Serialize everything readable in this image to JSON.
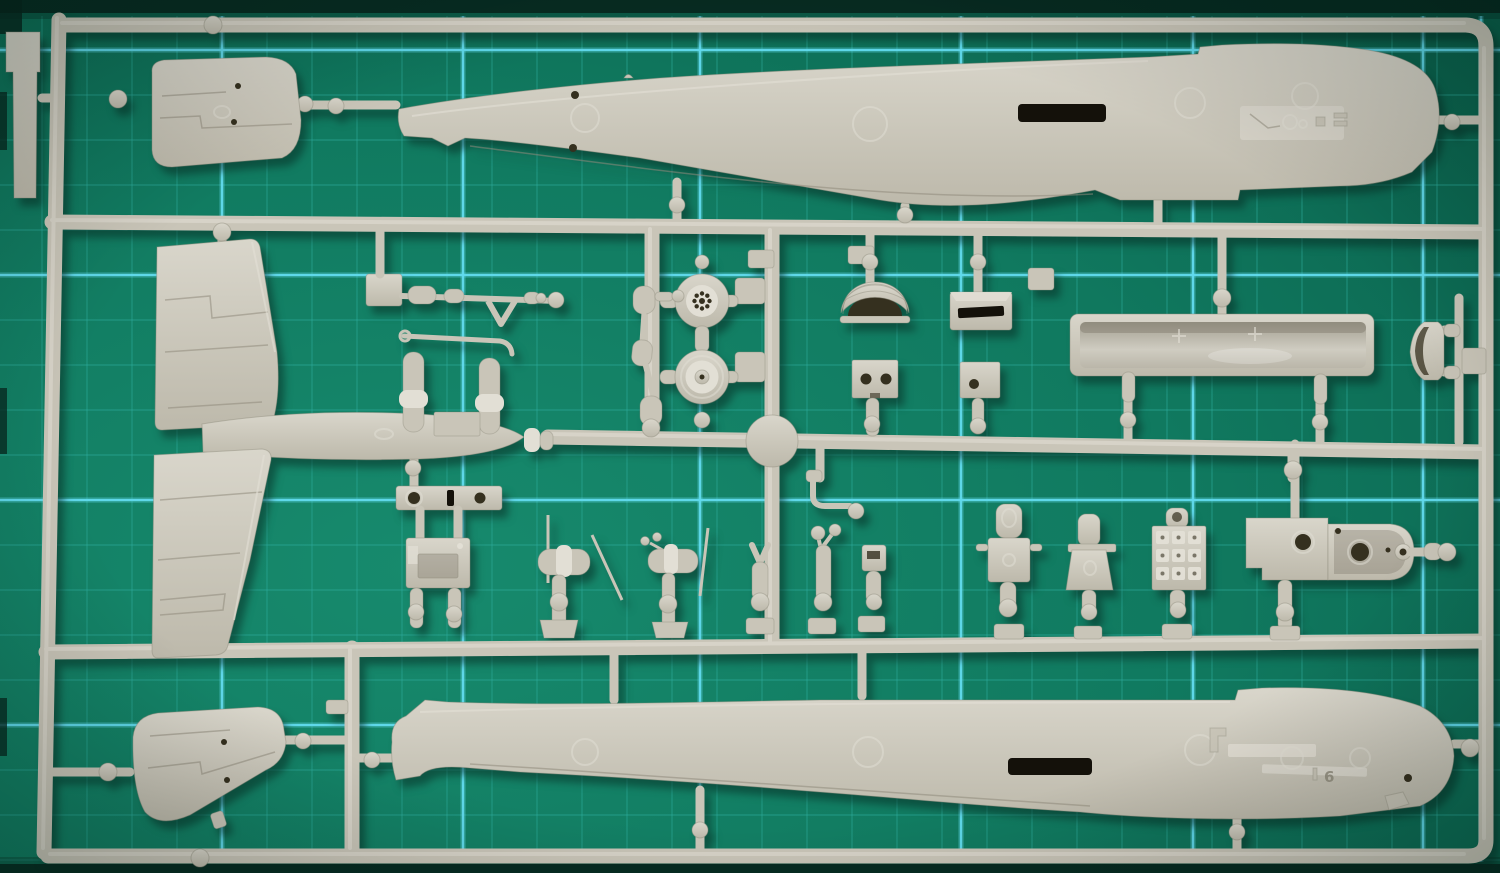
{
  "scene": {
    "type": "photograph",
    "subject": "Grey injection-moulded polystyrene model aircraft sprue (parts tree) lying flat on a green self-healing cutting mat with cyan grid lines",
    "camera": "top-down close-up",
    "visible_text": "single molded part-number digit on lower fuselage half"
  },
  "colors": {
    "mat_green_light": "#1a8d70",
    "mat_green": "#107a5f",
    "mat_green_dark": "#0a5e49",
    "mat_edge_dark": "#07261d",
    "grid_minor": "#2fae9f",
    "grid_major": "#62dbee",
    "plastic": "#c9c5b8",
    "plastic_light": "#e2dfd5",
    "plastic_dark": "#8f8b7c",
    "plastic_deep": "#6f6a5c",
    "hole_dark": "#35301f",
    "slot_black": "#14110a",
    "shadow": "rgba(5,40,31,0.5)"
  },
  "mat": {
    "description": "green self-healing cutting mat, dark top and bottom edge bands, faint 1cm teal grid with bright cyan 5cm lines",
    "grid": {
      "minor_spacing_px": 45,
      "minor_start_x": 42,
      "minor_start_y": 5,
      "minor_x_max": 1500,
      "minor_y_min": 16,
      "minor_y_max": 862,
      "major_vertical_x": [
        222,
        463,
        700,
        961,
        1193,
        1423,
        1481
      ],
      "major_horizontal_y": [
        50,
        275,
        500,
        725
      ]
    }
  },
  "sprue": {
    "material": "light grey polystyrene",
    "molded_digit": "6",
    "parts": [
      {
        "id": "sprue-frame",
        "label": "rectangular runner frame with three internal cross-runners"
      },
      {
        "id": "tab-plate",
        "label": "flat tab plate outside frame, top-left"
      },
      {
        "id": "tailplane-half-upper",
        "label": "tailplane half with elevator hinge line (top-left)"
      },
      {
        "id": "fuselage-half-upper",
        "label": "fuselage half, interior facing up, cockpit sidewall detail at nose (top)"
      },
      {
        "id": "wing-panel-upper",
        "label": "wing skin panel (left, upper)"
      },
      {
        "id": "wing-root-fairing",
        "label": "wing-root fairing section (left centre)"
      },
      {
        "id": "wing-panel-lower",
        "label": "wing skin panel (left, lower)"
      },
      {
        "id": "tailplane-half-lower",
        "label": "tailplane half (bottom-left)"
      },
      {
        "id": "fuselage-half-lower",
        "label": "fuselage half, interior facing up, molded digit 6 (bottom)"
      },
      {
        "id": "main-wheel-spoked",
        "label": "main wheel with spoked hub"
      },
      {
        "id": "main-wheel-plain",
        "label": "main wheel with plain hub"
      },
      {
        "id": "intake-dome",
        "label": "half-round air-intake scoop"
      },
      {
        "id": "intake-box",
        "label": "rectangular intake scoop with slot"
      },
      {
        "id": "bulkhead-two-holes",
        "label": "square bulkhead plate with two holes"
      },
      {
        "id": "bulkhead-one-hole",
        "label": "square bulkhead plate with one hole"
      },
      {
        "id": "cockpit-tub",
        "label": "long open cockpit floor trough"
      },
      {
        "id": "d-frame-part",
        "label": "small D-shaped frame part (far right)"
      },
      {
        "id": "retraction-arm",
        "label": "landing-gear retraction arm with V-bracket"
      },
      {
        "id": "twin-strut",
        "label": "twin cylindrical struts with cross-bar and hook"
      },
      {
        "id": "gear-leg",
        "label": "small articulated landing-gear leg"
      },
      {
        "id": "hatch-plate",
        "label": "access hatch strip with two holes and slot"
      },
      {
        "id": "equipment-box",
        "label": "rectangular equipment box with recess"
      },
      {
        "id": "control-column-a",
        "label": "control column with long rods"
      },
      {
        "id": "control-column-b",
        "label": "control column with long rods and grips"
      },
      {
        "id": "fork-fitting",
        "label": "small Y-fork fitting"
      },
      {
        "id": "mast-with-discs",
        "label": "small mast with twin discs"
      },
      {
        "id": "bracket-small",
        "label": "small notched bracket"
      },
      {
        "id": "elbow-pipe",
        "label": "elbow pipe fitting with disc"
      },
      {
        "id": "crew-seat-a",
        "label": "crew seat with rounded headrest"
      },
      {
        "id": "crew-seat-b",
        "label": "crew seat with flared back"
      },
      {
        "id": "instrument-panel",
        "label": "instrument panel with 3x3 raised bezels"
      },
      {
        "id": "equipment-plate",
        "label": "flat equipment plate with hole"
      },
      {
        "id": "gun-trough-box",
        "label": "open trough box with eyelet end"
      },
      {
        "id": "gate-balls",
        "label": "round sprue gates connecting parts to runners"
      }
    ]
  }
}
